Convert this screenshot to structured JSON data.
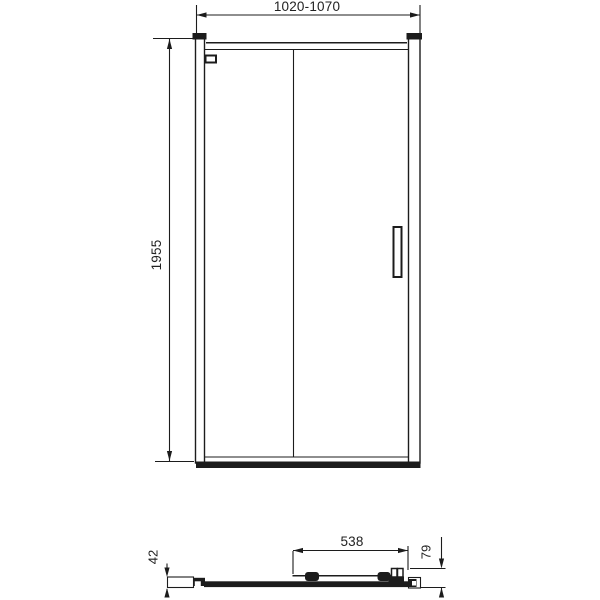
{
  "document": {
    "type": "technical-drawing",
    "subject": "sliding-door-dimension-diagram"
  },
  "colors": {
    "line": "#1c1c1c",
    "background": "#ffffff",
    "text": "#222222"
  },
  "front_view": {
    "width_dimension": "1020-1070",
    "height_dimension": "1955"
  },
  "plan_view": {
    "sliding_panel_width_dimension": "538",
    "total_depth_dimension": "79",
    "wall_profile_dimension": "42"
  }
}
